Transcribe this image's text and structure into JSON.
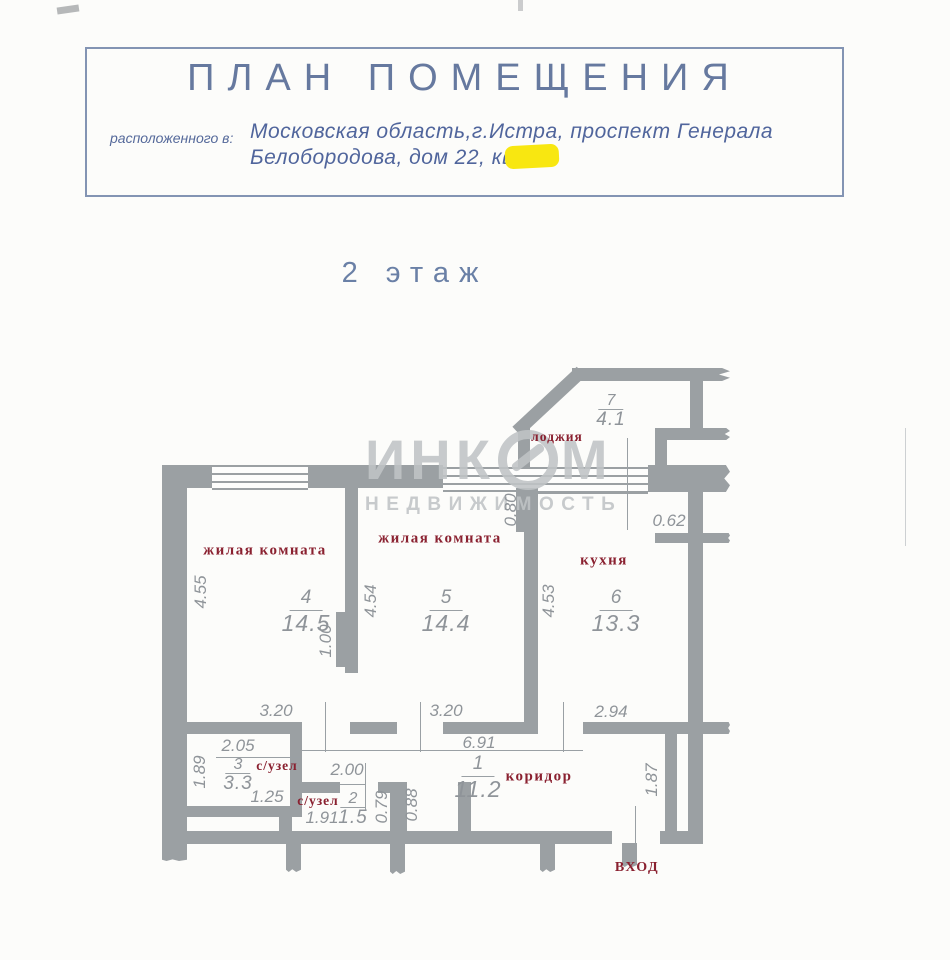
{
  "title_block": {
    "title": "ПЛАН ПОМЕЩЕНИЯ",
    "located_prefix": "расположенного в:",
    "address_line1": "Московская область,г.Истра, проспект Генерала",
    "address_line2": "Белобородова,  дом 22, кв.",
    "redaction_color": "#f8e711"
  },
  "floor_label": "2 этаж",
  "watermark": {
    "text": "ИНКОМ",
    "text_left": "ИНК",
    "text_right": "М",
    "subtext": "НЕДВИЖИМОСТЬ"
  },
  "rooms": {
    "r4": {
      "name": "жилая комната",
      "number": "4",
      "area": "14.5"
    },
    "r5": {
      "name": "жилая комната",
      "number": "5",
      "area": "14.4"
    },
    "r6": {
      "name": "кухня",
      "number": "6",
      "area": "13.3"
    },
    "r7": {
      "name": "лоджия",
      "number": "7",
      "area": "4.1"
    },
    "r3": {
      "name": "с/узел",
      "number": "3",
      "area": "3.3"
    },
    "r2": {
      "name": "с/узел",
      "number": "2",
      "area": "1.5"
    },
    "r1": {
      "name": "коридор",
      "number": "1",
      "area": "11.2"
    }
  },
  "entrance_label": "вход",
  "dims": [
    "4.55",
    "3.20",
    "1.00",
    "4.54",
    "3.20",
    "0.80",
    "4.53",
    "2.94",
    "0.62",
    "6.91",
    "2.05",
    "1.89",
    "1.25",
    "2.00",
    "1.91",
    "0.79",
    "0.88",
    "1.87"
  ],
  "colors": {
    "wall_gray": "#9ba0a3",
    "dimension_text": "#8f9499",
    "room_label_maroon": "#8a2130",
    "title_blue": "#66799f",
    "watermark_gray": "#c0c4c6",
    "redaction_yellow": "#f8e711"
  }
}
